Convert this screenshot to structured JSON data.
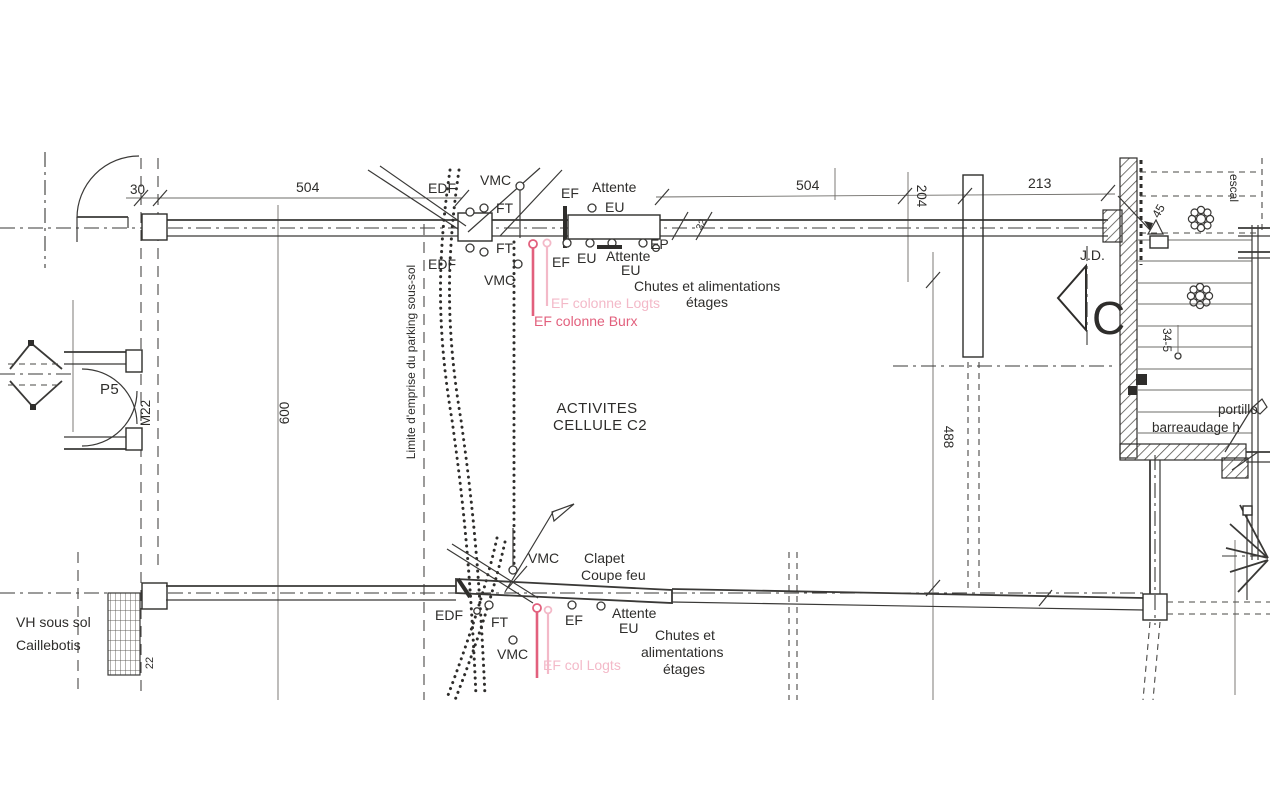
{
  "plan": {
    "room": {
      "line1": "ACTIVITES",
      "line2": "CELLULE C2"
    },
    "dimensions": {
      "d30": "30",
      "d504a": "504",
      "d504b": "504",
      "d204": "204",
      "d213": "213",
      "d32": "32",
      "d600": "600",
      "d488": "488",
      "d345": "34-5",
      "d22": "22",
      "d45": "45"
    },
    "risers_top": {
      "edf": "EDF",
      "vmc": "VMC",
      "ft": "FT",
      "ef": "EF",
      "attente": "Attente",
      "eu": "EU",
      "edf2": "EDF",
      "ft2": "FT",
      "vmc2": "VMC",
      "ef2": "EF",
      "eu2": "EU",
      "attente2": "Attente",
      "eu3": "EU",
      "ep": "EP",
      "chutes1": "Chutes et alimentations",
      "chutes2": "étages",
      "ef_colonne_logts": "EF colonne Logts",
      "ef_colonne_burx": "EF colonne Burx"
    },
    "risers_bottom": {
      "vmc": "VMC",
      "clapet1": "Clapet",
      "clapet2": "Coupe feu",
      "edf": "EDF",
      "ft": "FT",
      "ef": "EF",
      "attente": "Attente",
      "eu": "EU",
      "chutes1": "Chutes et",
      "chutes2": "alimentations",
      "chutes3": "étages",
      "ef_col_logts": "EF col Logts",
      "vmc2": "VMC"
    },
    "left": {
      "p5": "P5",
      "m22": "M22",
      "limite": "Limite d'emprise du parking sous-sol",
      "vh1": "VH sous sol",
      "vh2": "Caillebotis"
    },
    "right": {
      "jd": "J.D.",
      "section": "C",
      "escal": "escal",
      "portillon": "portillo",
      "barreaudage": "barreaudage h"
    },
    "colors": {
      "ink": "#2e2d2b",
      "pink": "#e2607d",
      "pink_light": "#f3b9c8"
    }
  }
}
